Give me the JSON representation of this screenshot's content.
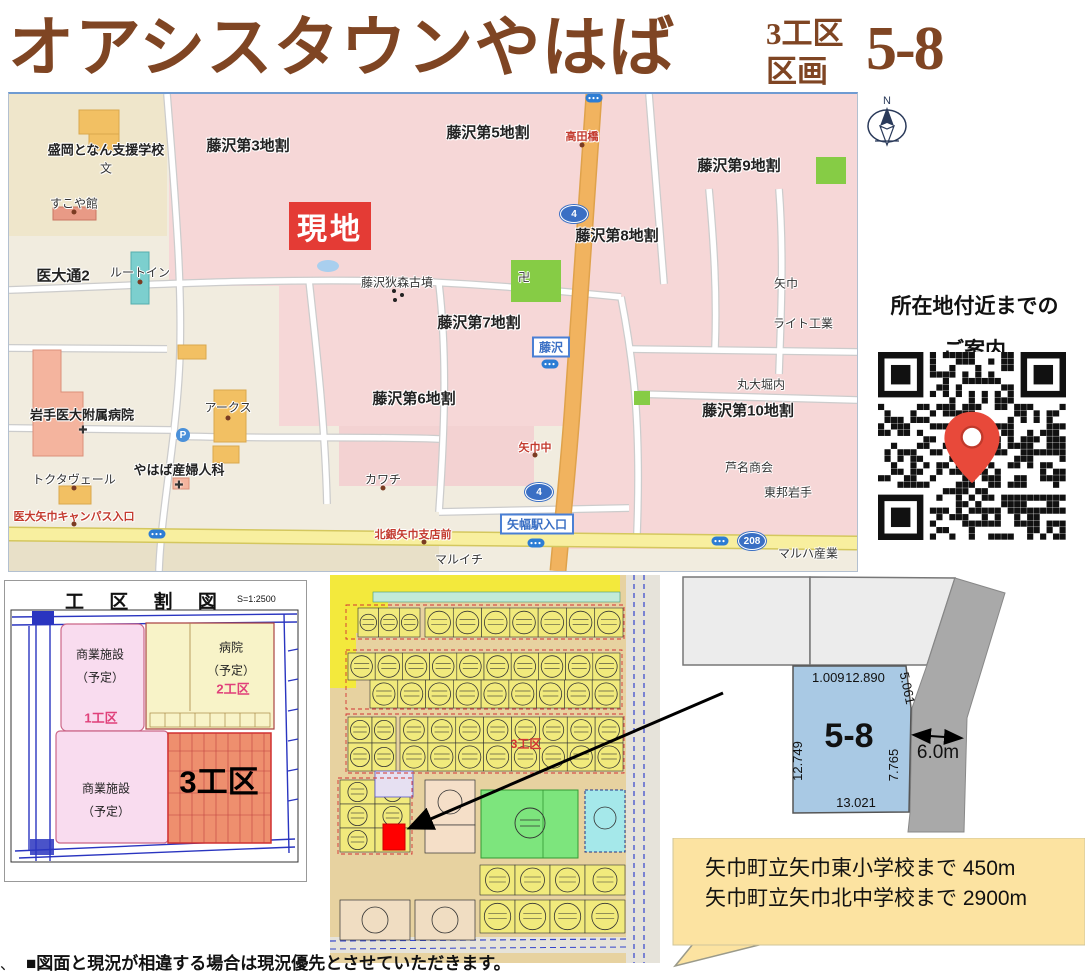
{
  "header": {
    "title": "オアシスタウンやはば",
    "block": "3工区",
    "kukaku": "区画",
    "lot": "5-8"
  },
  "map": {
    "site_label": "現地",
    "compass": "N",
    "parking": "P",
    "labels": [
      "盛岡となん支援学校",
      "文",
      "すこや館",
      "医大通2",
      "ルートイン",
      "藤沢第3地割",
      "藤沢第5地割",
      "藤沢第9地割",
      "藤沢第8地割",
      "藤沢狄森古墳",
      "藤沢第7地割",
      "矢巾",
      "ライト工業",
      "岩手医大附属病院",
      "アークス",
      "藤沢第6地割",
      "丸大堀内",
      "藤沢第10地割",
      "トクタヴェール",
      "やはば産婦人科",
      "カワチ",
      "芦名商会",
      "東邦岩手",
      "医大矢巾キャンパス入口",
      "北銀矢巾支店前",
      "高田橋",
      "矢巾中",
      "マルイチ",
      "マルハ産業",
      "卍"
    ],
    "signs": [
      "藤沢",
      "矢幅駅入口"
    ],
    "badges": [
      "4",
      "4",
      "208"
    ],
    "hospital_mark": "✚"
  },
  "guide": {
    "line1": "所在地付近までの",
    "line2": "ご案内"
  },
  "division_map": {
    "title": "工 区 割 図",
    "scale": "S=1:2500",
    "zone1": {
      "name": "商業施設",
      "sub": "（予定）",
      "tag": "1工区"
    },
    "zone2": {
      "name": "病院",
      "sub": "（予定）",
      "tag": "2工区"
    },
    "zone3": {
      "name": "商業施設",
      "sub": "（予定）"
    },
    "zone4": {
      "tag": "3工区"
    }
  },
  "lot_map": {
    "tag": "3工区"
  },
  "lot_diagram": {
    "lot": "5-8",
    "dim_top_left": "1.009",
    "dim_top": "12.890",
    "dim_top_right": "5.061",
    "dim_left": "12.749",
    "dim_right": "7.765",
    "dim_bottom": "13.021",
    "road_width": "6.0m"
  },
  "info_box": {
    "line1": "矢巾町立矢巾東小学校まで 450m",
    "line2": "矢巾町立矢巾北中学校まで 2900m"
  },
  "disclaimer": "■図面と現況が相違する場合は現況優先とさせていただきます。",
  "corner_mark": "、",
  "colors": {
    "title_brown": "#7f4523",
    "site_red": "#e43b35",
    "lot_blue": "#a9c9e4",
    "info_yellow": "#fce3a1"
  }
}
